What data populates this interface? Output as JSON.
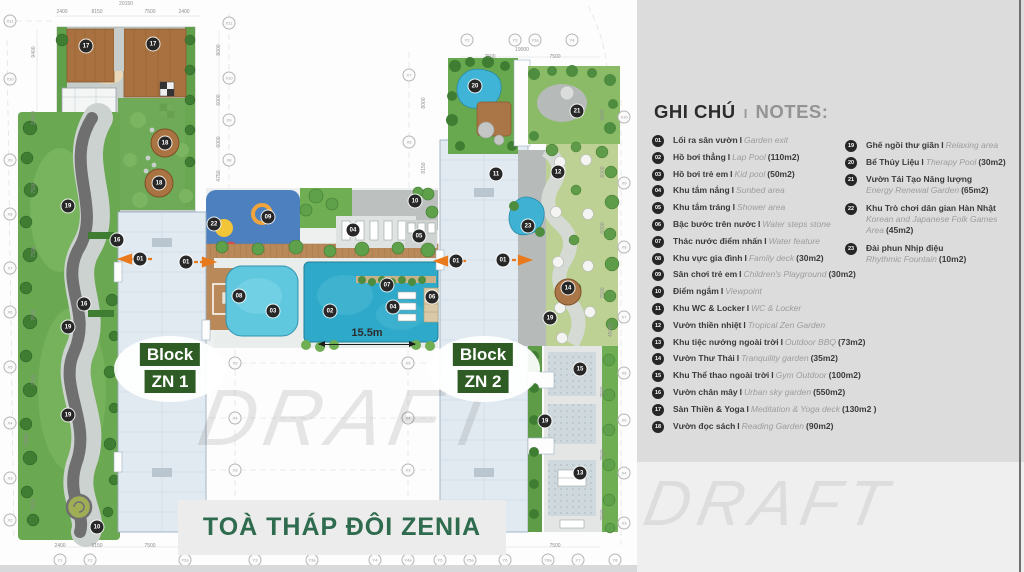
{
  "legend": {
    "title_vi": "GHI CHÚ",
    "title_sep": "I",
    "title_en": "NOTES:",
    "col1": [
      {
        "n": "01",
        "vi": "Lối ra sân vườn",
        "sep": "I",
        "en": "Garden exit",
        "area": "",
        "stacked": ""
      },
      {
        "n": "02",
        "vi": "Hồ bơi thẳng",
        "sep": "I",
        "en": "Lap Pool",
        "area": "(110m2)",
        "stacked": ""
      },
      {
        "n": "03",
        "vi": "Hồ bơi trẻ em",
        "sep": "I",
        "en": "Kid pool",
        "area": "(50m2)",
        "stacked": ""
      },
      {
        "n": "04",
        "vi": "Khu tắm nắng",
        "sep": "I",
        "en": "Sunbed area",
        "area": "",
        "stacked": ""
      },
      {
        "n": "05",
        "vi": "Khu tắm tráng",
        "sep": "I",
        "en": "Shower area",
        "area": "",
        "stacked": ""
      },
      {
        "n": "06",
        "vi": "Bậc bước trên nước",
        "sep": "I",
        "en": "Water steps stone",
        "area": "",
        "stacked": ""
      },
      {
        "n": "07",
        "vi": "Thác nước điểm nhấn",
        "sep": "I",
        "en": "Water feature",
        "area": "",
        "stacked": ""
      },
      {
        "n": "08",
        "vi": "Khu vực gia đình",
        "sep": "I",
        "en": "Family deck",
        "area": "(30m2)",
        "stacked": ""
      },
      {
        "n": "09",
        "vi": "Sân chơi trẻ em",
        "sep": "I",
        "en": "Children's Playground",
        "area": "(30m2)",
        "stacked": ""
      },
      {
        "n": "10",
        "vi": "Điểm ngắm",
        "sep": "I",
        "en": "Viewpoint",
        "area": "",
        "stacked": ""
      },
      {
        "n": "11",
        "vi": "Khu WC & Locker",
        "sep": "I",
        "en": "WC & Locker",
        "area": "",
        "stacked": ""
      },
      {
        "n": "12",
        "vi": "Vườn thiền nhiệt",
        "sep": "I",
        "en": "Tropical Zen Garden",
        "area": "",
        "stacked": ""
      },
      {
        "n": "13",
        "vi": "Khu tiệc nướng ngoài trời",
        "sep": "I",
        "en": "Outdoor BBQ",
        "area": "(73m2)",
        "stacked": ""
      },
      {
        "n": "14",
        "vi": "Vườn Thư Thái",
        "sep": "I",
        "en": "Tranquility garden",
        "area": "(35m2)",
        "stacked": ""
      },
      {
        "n": "15",
        "vi": "Khu Thể thao ngoài trời",
        "sep": "I",
        "en": "Gym Outdoor",
        "area": "(100m2)",
        "stacked": ""
      },
      {
        "n": "16",
        "vi": "Vườn chân mây",
        "sep": "I",
        "en": "Urban sky garden",
        "area": "(550m2)",
        "stacked": ""
      },
      {
        "n": "17",
        "vi": "Sàn Thiền & Yoga",
        "sep": "I",
        "en": "Meditation & Yoga deck",
        "area": "(130m2 )",
        "stacked": ""
      },
      {
        "n": "18",
        "vi": "Vườn đọc sách",
        "sep": "I",
        "en": "Reading Garden",
        "area": "(90m2)",
        "stacked": ""
      }
    ],
    "col2": [
      {
        "n": "19",
        "vi": "Ghế ngồi thư giãn",
        "sep": "I",
        "en": "Relaxing area",
        "area": "",
        "stacked": ""
      },
      {
        "n": "20",
        "vi": "Bể Thủy Liệu",
        "sep": "I",
        "en": "Therapy Pool",
        "area": "(30m2)",
        "stacked": ""
      },
      {
        "n": "21",
        "vi": "Vườn Tái Tạo Năng lượng",
        "sep": "",
        "en": "Energy Renewal Garden",
        "area": "(65m2)",
        "stacked": "stacked"
      },
      {
        "n": "22",
        "vi": "Khu Trò chơi dân gian Hàn Nhật",
        "sep": "",
        "en": "Korean and Japanese Folk Games Area",
        "area": "(45m2)",
        "stacked": "stacked"
      },
      {
        "n": "23",
        "vi": "Đài phun Nhịp điệu",
        "sep": "",
        "en": "Rhythmic Fountain",
        "area": "(10m2)",
        "stacked": "stacked"
      }
    ]
  },
  "plan": {
    "title": "TOÀ THÁP ĐÔI ZENIA",
    "block1_line1": "Block",
    "block1_line2": "ZN 1",
    "block2_line1": "Block",
    "block2_line2": "ZN 2",
    "dimension_label": "15.5m",
    "markers": [
      {
        "n": "17",
        "x": 86,
        "y": 46
      },
      {
        "n": "17",
        "x": 153,
        "y": 44
      },
      {
        "n": "18",
        "x": 165,
        "y": 143
      },
      {
        "n": "18",
        "x": 159,
        "y": 183
      },
      {
        "n": "19",
        "x": 68,
        "y": 206
      },
      {
        "n": "16",
        "x": 117,
        "y": 240
      },
      {
        "n": "01",
        "x": 140,
        "y": 259
      },
      {
        "n": "01",
        "x": 186,
        "y": 262
      },
      {
        "n": "16",
        "x": 84,
        "y": 304
      },
      {
        "n": "19",
        "x": 68,
        "y": 327
      },
      {
        "n": "19",
        "x": 68,
        "y": 415
      },
      {
        "n": "10",
        "x": 97,
        "y": 527
      },
      {
        "n": "22",
        "x": 214,
        "y": 224
      },
      {
        "n": "09",
        "x": 268,
        "y": 217
      },
      {
        "n": "10",
        "x": 415,
        "y": 201
      },
      {
        "n": "04",
        "x": 353,
        "y": 230
      },
      {
        "n": "05",
        "x": 419,
        "y": 236
      },
      {
        "n": "08",
        "x": 239,
        "y": 296
      },
      {
        "n": "03",
        "x": 273,
        "y": 311
      },
      {
        "n": "02",
        "x": 330,
        "y": 311
      },
      {
        "n": "07",
        "x": 387,
        "y": 285
      },
      {
        "n": "04",
        "x": 393,
        "y": 307
      },
      {
        "n": "06",
        "x": 432,
        "y": 297
      },
      {
        "n": "01",
        "x": 456,
        "y": 261
      },
      {
        "n": "01",
        "x": 503,
        "y": 260
      },
      {
        "n": "20",
        "x": 475,
        "y": 86
      },
      {
        "n": "21",
        "x": 577,
        "y": 111
      },
      {
        "n": "11",
        "x": 496,
        "y": 174
      },
      {
        "n": "12",
        "x": 558,
        "y": 172
      },
      {
        "n": "23",
        "x": 528,
        "y": 226
      },
      {
        "n": "14",
        "x": 568,
        "y": 288
      },
      {
        "n": "19",
        "x": 550,
        "y": 318
      },
      {
        "n": "15",
        "x": 580,
        "y": 369
      },
      {
        "n": "19",
        "x": 545,
        "y": 421
      },
      {
        "n": "13",
        "x": 580,
        "y": 473
      }
    ],
    "grid_bubbles": [
      {
        "label": "X11",
        "x": 10,
        "y": 21
      },
      {
        "label": "X10",
        "x": 10,
        "y": 79
      },
      {
        "label": "X9",
        "x": 10,
        "y": 160
      },
      {
        "label": "X8",
        "x": 10,
        "y": 214
      },
      {
        "label": "X7",
        "x": 10,
        "y": 268
      },
      {
        "label": "X6",
        "x": 10,
        "y": 312
      },
      {
        "label": "X5",
        "x": 10,
        "y": 367
      },
      {
        "label": "X4",
        "x": 10,
        "y": 423
      },
      {
        "label": "X3",
        "x": 10,
        "y": 478
      },
      {
        "label": "X2",
        "x": 10,
        "y": 520
      },
      {
        "label": "X11",
        "x": 229,
        "y": 23
      },
      {
        "label": "X10",
        "x": 229,
        "y": 78
      },
      {
        "label": "X9",
        "x": 229,
        "y": 120
      },
      {
        "label": "X8",
        "x": 229,
        "y": 160
      },
      {
        "label": "X7",
        "x": 409,
        "y": 75
      },
      {
        "label": "X6",
        "x": 409,
        "y": 142
      },
      {
        "label": "Y2",
        "x": 467,
        "y": 40
      },
      {
        "label": "Y3",
        "x": 515,
        "y": 40
      },
      {
        "label": "Y3a",
        "x": 535,
        "y": 40
      },
      {
        "label": "Y4",
        "x": 572,
        "y": 40
      },
      {
        "label": "X10",
        "x": 624,
        "y": 117
      },
      {
        "label": "X9",
        "x": 624,
        "y": 183
      },
      {
        "label": "X8",
        "x": 624,
        "y": 247
      },
      {
        "label": "X7",
        "x": 624,
        "y": 317
      },
      {
        "label": "X6",
        "x": 624,
        "y": 373
      },
      {
        "label": "X5",
        "x": 624,
        "y": 420
      },
      {
        "label": "X4",
        "x": 624,
        "y": 473
      },
      {
        "label": "X3",
        "x": 624,
        "y": 523
      },
      {
        "label": "X5",
        "x": 235,
        "y": 363
      },
      {
        "label": "X5",
        "x": 408,
        "y": 363
      },
      {
        "label": "X4",
        "x": 235,
        "y": 418
      },
      {
        "label": "X4",
        "x": 408,
        "y": 418
      },
      {
        "label": "X3",
        "x": 235,
        "y": 470
      },
      {
        "label": "X3",
        "x": 408,
        "y": 470
      },
      {
        "label": "Y1",
        "x": 60,
        "y": 560
      },
      {
        "label": "Y2",
        "x": 90,
        "y": 560
      },
      {
        "label": "Y2a",
        "x": 185,
        "y": 560
      },
      {
        "label": "Y3",
        "x": 255,
        "y": 560
      },
      {
        "label": "Y3a",
        "x": 312,
        "y": 560
      },
      {
        "label": "Y4",
        "x": 375,
        "y": 560
      },
      {
        "label": "Y4a",
        "x": 408,
        "y": 560
      },
      {
        "label": "Y5",
        "x": 440,
        "y": 560
      },
      {
        "label": "Y5a",
        "x": 470,
        "y": 560
      },
      {
        "label": "Y6",
        "x": 505,
        "y": 560
      },
      {
        "label": "Y6a",
        "x": 548,
        "y": 560
      },
      {
        "label": "Y7",
        "x": 578,
        "y": 560
      },
      {
        "label": "Y8",
        "x": 615,
        "y": 560
      }
    ],
    "dim_texts": [
      {
        "t": "9400",
        "x": 34,
        "y": 52,
        "rot": "r90"
      },
      {
        "t": "10600",
        "x": 34,
        "y": 118,
        "rot": "r90"
      },
      {
        "t": "7500",
        "x": 34,
        "y": 188,
        "rot": "r90"
      },
      {
        "t": "7500",
        "x": 34,
        "y": 252,
        "rot": "r90"
      },
      {
        "t": "7500",
        "x": 34,
        "y": 315,
        "rot": "r90"
      },
      {
        "t": "7500",
        "x": 34,
        "y": 380,
        "rot": "r90"
      },
      {
        "t": "72500",
        "x": 27,
        "y": 440,
        "rot": "r90"
      },
      {
        "t": "7500",
        "x": 34,
        "y": 505,
        "rot": "r90"
      },
      {
        "t": "8000",
        "x": 219,
        "y": 50,
        "rot": "r90"
      },
      {
        "t": "6000",
        "x": 219,
        "y": 100,
        "rot": "r90"
      },
      {
        "t": "6000",
        "x": 219,
        "y": 142,
        "rot": "r90"
      },
      {
        "t": "4750",
        "x": 219,
        "y": 176,
        "rot": "r90"
      },
      {
        "t": "8000",
        "x": 424,
        "y": 103,
        "rot": "r90"
      },
      {
        "t": "9150",
        "x": 424,
        "y": 168,
        "rot": "r90"
      },
      {
        "t": "8000",
        "x": 603,
        "y": 115,
        "rot": "r90"
      },
      {
        "t": "6000",
        "x": 603,
        "y": 172,
        "rot": "r90"
      },
      {
        "t": "6000",
        "x": 603,
        "y": 228,
        "rot": "r90"
      },
      {
        "t": "7500",
        "x": 603,
        "y": 293,
        "rot": "r90"
      },
      {
        "t": "45000",
        "x": 611,
        "y": 330,
        "rot": "r90"
      },
      {
        "t": "7500",
        "x": 603,
        "y": 392,
        "rot": "r90"
      },
      {
        "t": "7500",
        "x": 603,
        "y": 455,
        "rot": "r90"
      },
      {
        "t": "7500",
        "x": 603,
        "y": 515,
        "rot": "r90"
      },
      {
        "t": "2400",
        "x": 62,
        "y": 12,
        "rot": ""
      },
      {
        "t": "8150",
        "x": 97,
        "y": 12,
        "rot": ""
      },
      {
        "t": "7500",
        "x": 150,
        "y": 12,
        "rot": ""
      },
      {
        "t": "2400",
        "x": 184,
        "y": 12,
        "rot": ""
      },
      {
        "t": "20150",
        "x": 126,
        "y": 4,
        "rot": ""
      },
      {
        "t": "7500",
        "x": 490,
        "y": 57,
        "rot": ""
      },
      {
        "t": "7500",
        "x": 555,
        "y": 57,
        "rot": ""
      },
      {
        "t": "19000",
        "x": 522,
        "y": 50,
        "rot": ""
      },
      {
        "t": "2400",
        "x": 60,
        "y": 546,
        "rot": ""
      },
      {
        "t": "8150",
        "x": 97,
        "y": 546,
        "rot": ""
      },
      {
        "t": "7500",
        "x": 150,
        "y": 546,
        "rot": ""
      },
      {
        "t": "2400",
        "x": 185,
        "y": 546,
        "rot": ""
      },
      {
        "t": "7500",
        "x": 555,
        "y": 546,
        "rot": ""
      },
      {
        "t": "9150",
        "x": 350,
        "y": 551,
        "rot": ""
      }
    ]
  },
  "watermarks": {
    "plan": "DRAFT",
    "panel": "DRAFT"
  },
  "colors": {
    "panel_gray": "#dcdcdc",
    "panel_light": "#efefef",
    "badge_black": "#272727",
    "label_green": "#2e5c24",
    "title_green": "#2f6b4e",
    "pool_blue": "#2fa9c9",
    "kid_pool_blue": "#5fc8de",
    "deck_wood": "#b9895a",
    "lawn_green": "#6aa851",
    "zen_green": "#bdd194",
    "path_gray": "#6f6f6f",
    "arrow_orange": "#e8791d",
    "building_fill": "#e2eaf1"
  }
}
